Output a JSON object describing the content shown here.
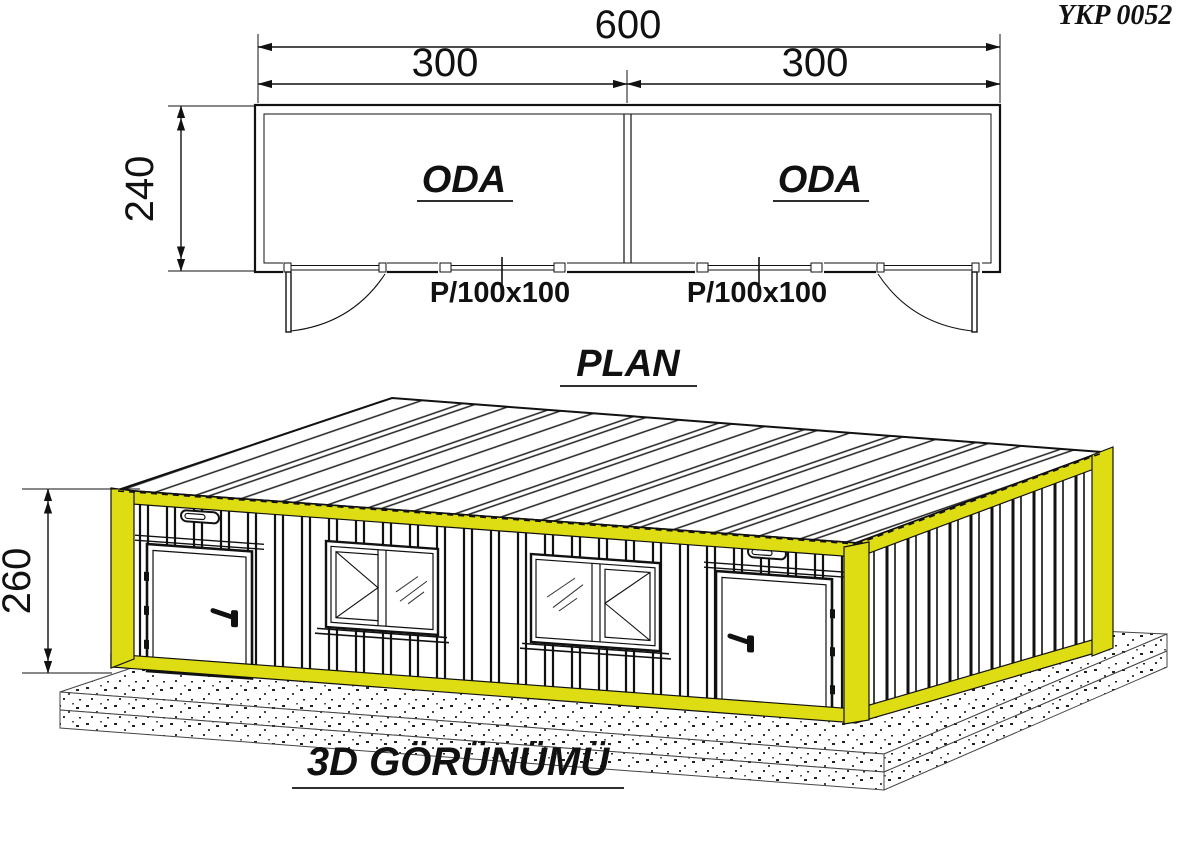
{
  "meta": {
    "drawing_code": "YKP 0052"
  },
  "plan": {
    "title": "PLAN",
    "rooms": [
      {
        "label": "ODA"
      },
      {
        "label": "ODA"
      }
    ],
    "dimensions": {
      "total_width": "600",
      "left_width": "300",
      "right_width": "300",
      "depth": "240"
    },
    "window_labels": [
      "P/100x100",
      "P/100x100"
    ]
  },
  "view3d": {
    "title": "3D GÖRÜNÜMÜ",
    "dimensions": {
      "height": "260"
    },
    "accent_color": "#dedc12"
  }
}
